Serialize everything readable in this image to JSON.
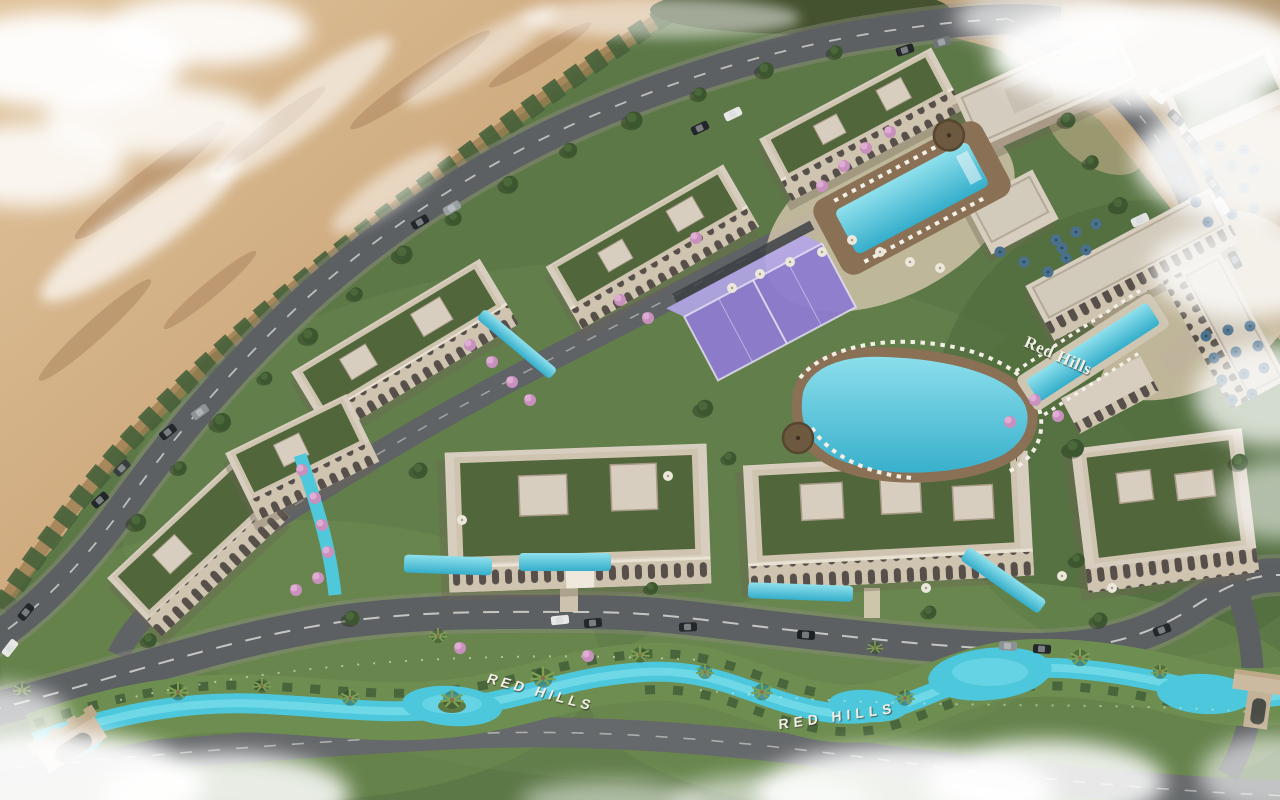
{
  "window": {
    "title": "Red Hills — aerial masterplan rendering"
  },
  "signs": {
    "hillside": "Red Hills",
    "canal_west": "RED HILLS",
    "canal_east": "RED HILLS"
  },
  "palette": {
    "desert_sand": "#c9a379",
    "lawn_green": "#5d7847",
    "roof_garden_green": "#51663b",
    "road_asphalt": "#5d6063",
    "canal_water": "#4cc7dc",
    "pool_water": "#57c6d9",
    "building_wall": "#d8cec0",
    "deck_wood": "#8a7054",
    "padel_purple": "#8d7bd0",
    "umbrella_blue": "#49708c",
    "blossom_pink": "#c890bd",
    "cloud_white": "#ffffff"
  }
}
